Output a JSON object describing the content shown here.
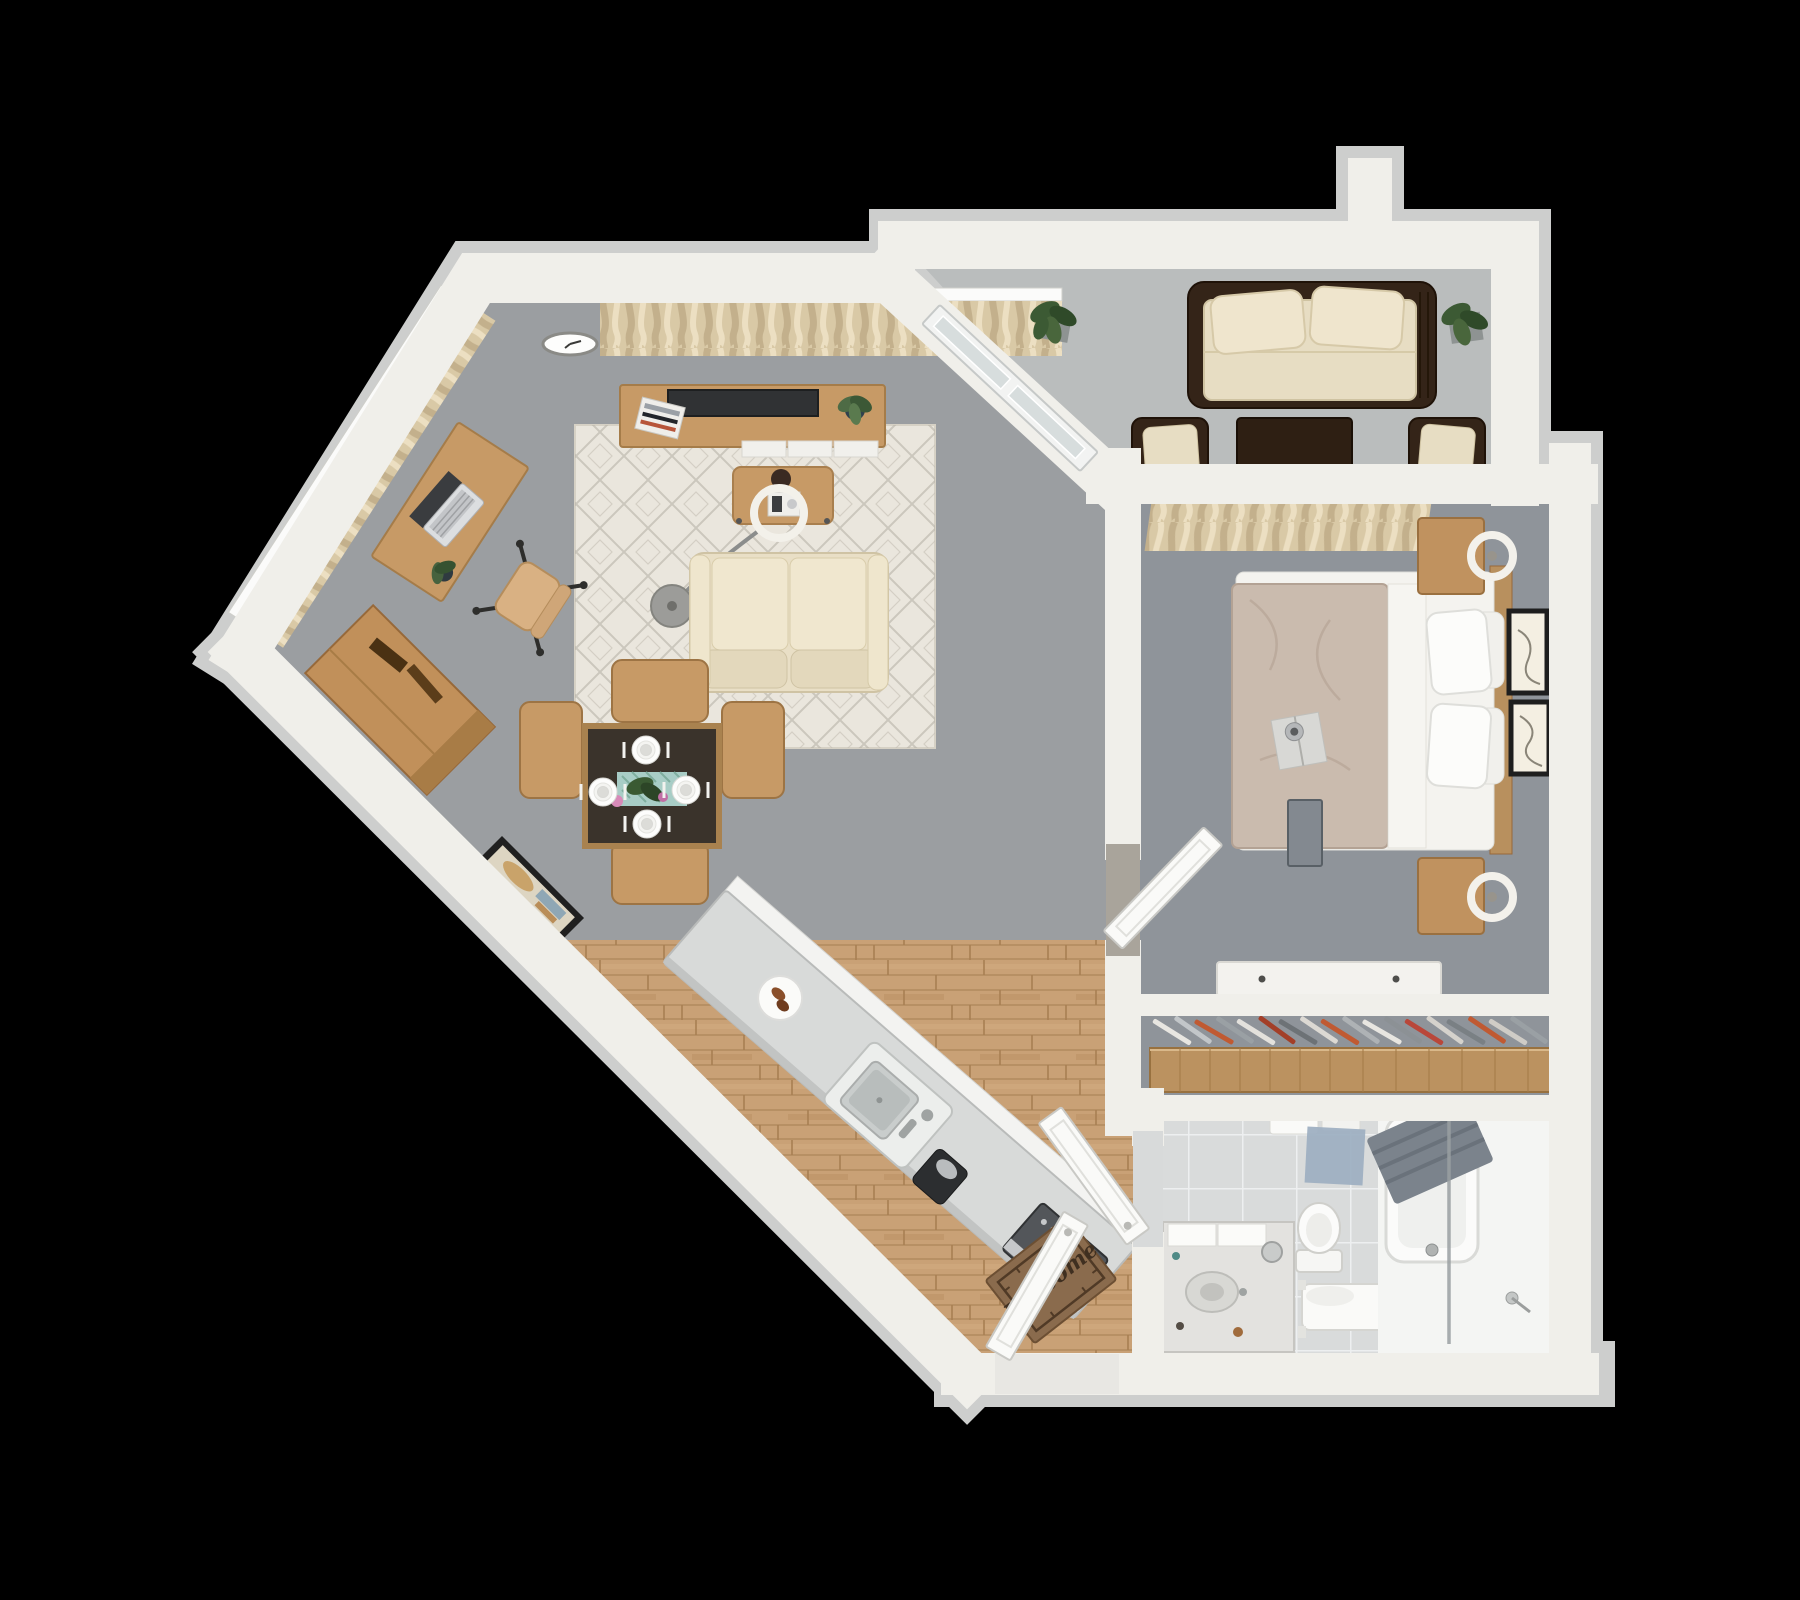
{
  "scene": {
    "type": "3d-floor-plan-render",
    "view": "top-down dollhouse",
    "background": "#000000",
    "welcome_mat_text": "Welcome"
  },
  "palette": {
    "wall_top": "#f0efea",
    "wall_shadow": "#cdcecd",
    "living_carpet": "#9b9ea1",
    "bedroom_carpet": "#8f949a",
    "patio_concrete": "#babdbd",
    "hardwood": "#c9a176",
    "bathroom_tile": "#d9dbdb",
    "oak_furniture": "#c79a66",
    "dark_wicker": "#342418",
    "cream_cushion": "#e7ddc3",
    "duvet_taupe": "#cabbae",
    "rug_cream": "#eae6dd",
    "mat_brown": "#8a6b4d",
    "accent_hanger_red": "#c05a32"
  },
  "rooms": [
    {
      "id": "living-room",
      "floor": "gray carpet",
      "furniture": [
        "wall-clock",
        "window-with-curtains-top",
        "window-with-curtains-diagonal",
        "tv-console",
        "television",
        "magazines",
        "console-plant",
        "area-rug",
        "coffee-table",
        "arc-floor-lamp",
        "sofa",
        "desk",
        "laptop",
        "desk-plant",
        "desk-chair",
        "dresser",
        "framed-wall-art",
        "dining-table",
        "dining-chair x4",
        "place-setting x4",
        "table-runner",
        "centerpiece-plant",
        "flowers"
      ]
    },
    {
      "id": "kitchen-entry",
      "floor": "hardwood planks",
      "furniture": [
        "kitchen-island",
        "island-sink",
        "serving-plate",
        "coffee-maker",
        "toaster-oven",
        "runner-rug",
        "welcome-mat",
        "entry-door",
        "bathroom-door"
      ]
    },
    {
      "id": "patio",
      "floor": "concrete",
      "furniture": [
        "outdoor-wicker-sofa",
        "outdoor-pillows x2",
        "outdoor-coffee-table",
        "outdoor-wicker-chair x2",
        "potted-plant x2",
        "sliding-glass-door"
      ]
    },
    {
      "id": "bedroom",
      "floor": "gray carpet",
      "furniture": [
        "window-with-curtains",
        "bed",
        "duvet",
        "pillows x4",
        "headboard",
        "book-and-mug",
        "nightstand x2",
        "table-lamp x2",
        "framed-art x2",
        "wall-tv",
        "white-console",
        "bedroom-door"
      ]
    },
    {
      "id": "closet",
      "floor": "gray carpet",
      "furniture": [
        "closet-rod-shelf",
        "clothes-hangers x18"
      ]
    },
    {
      "id": "bathroom",
      "floor": "light tile",
      "furniture": [
        "vanity-with-sink",
        "toilet",
        "trash-bin",
        "bath-bench",
        "towels",
        "blue-bath-mat",
        "bathtub",
        "gray-towel",
        "glass-shower-screen",
        "hand-shower"
      ]
    }
  ],
  "counts": {
    "bedrooms": 1,
    "bathrooms": 1,
    "patios": 1,
    "dining_seats": 4,
    "hangers": 18
  }
}
